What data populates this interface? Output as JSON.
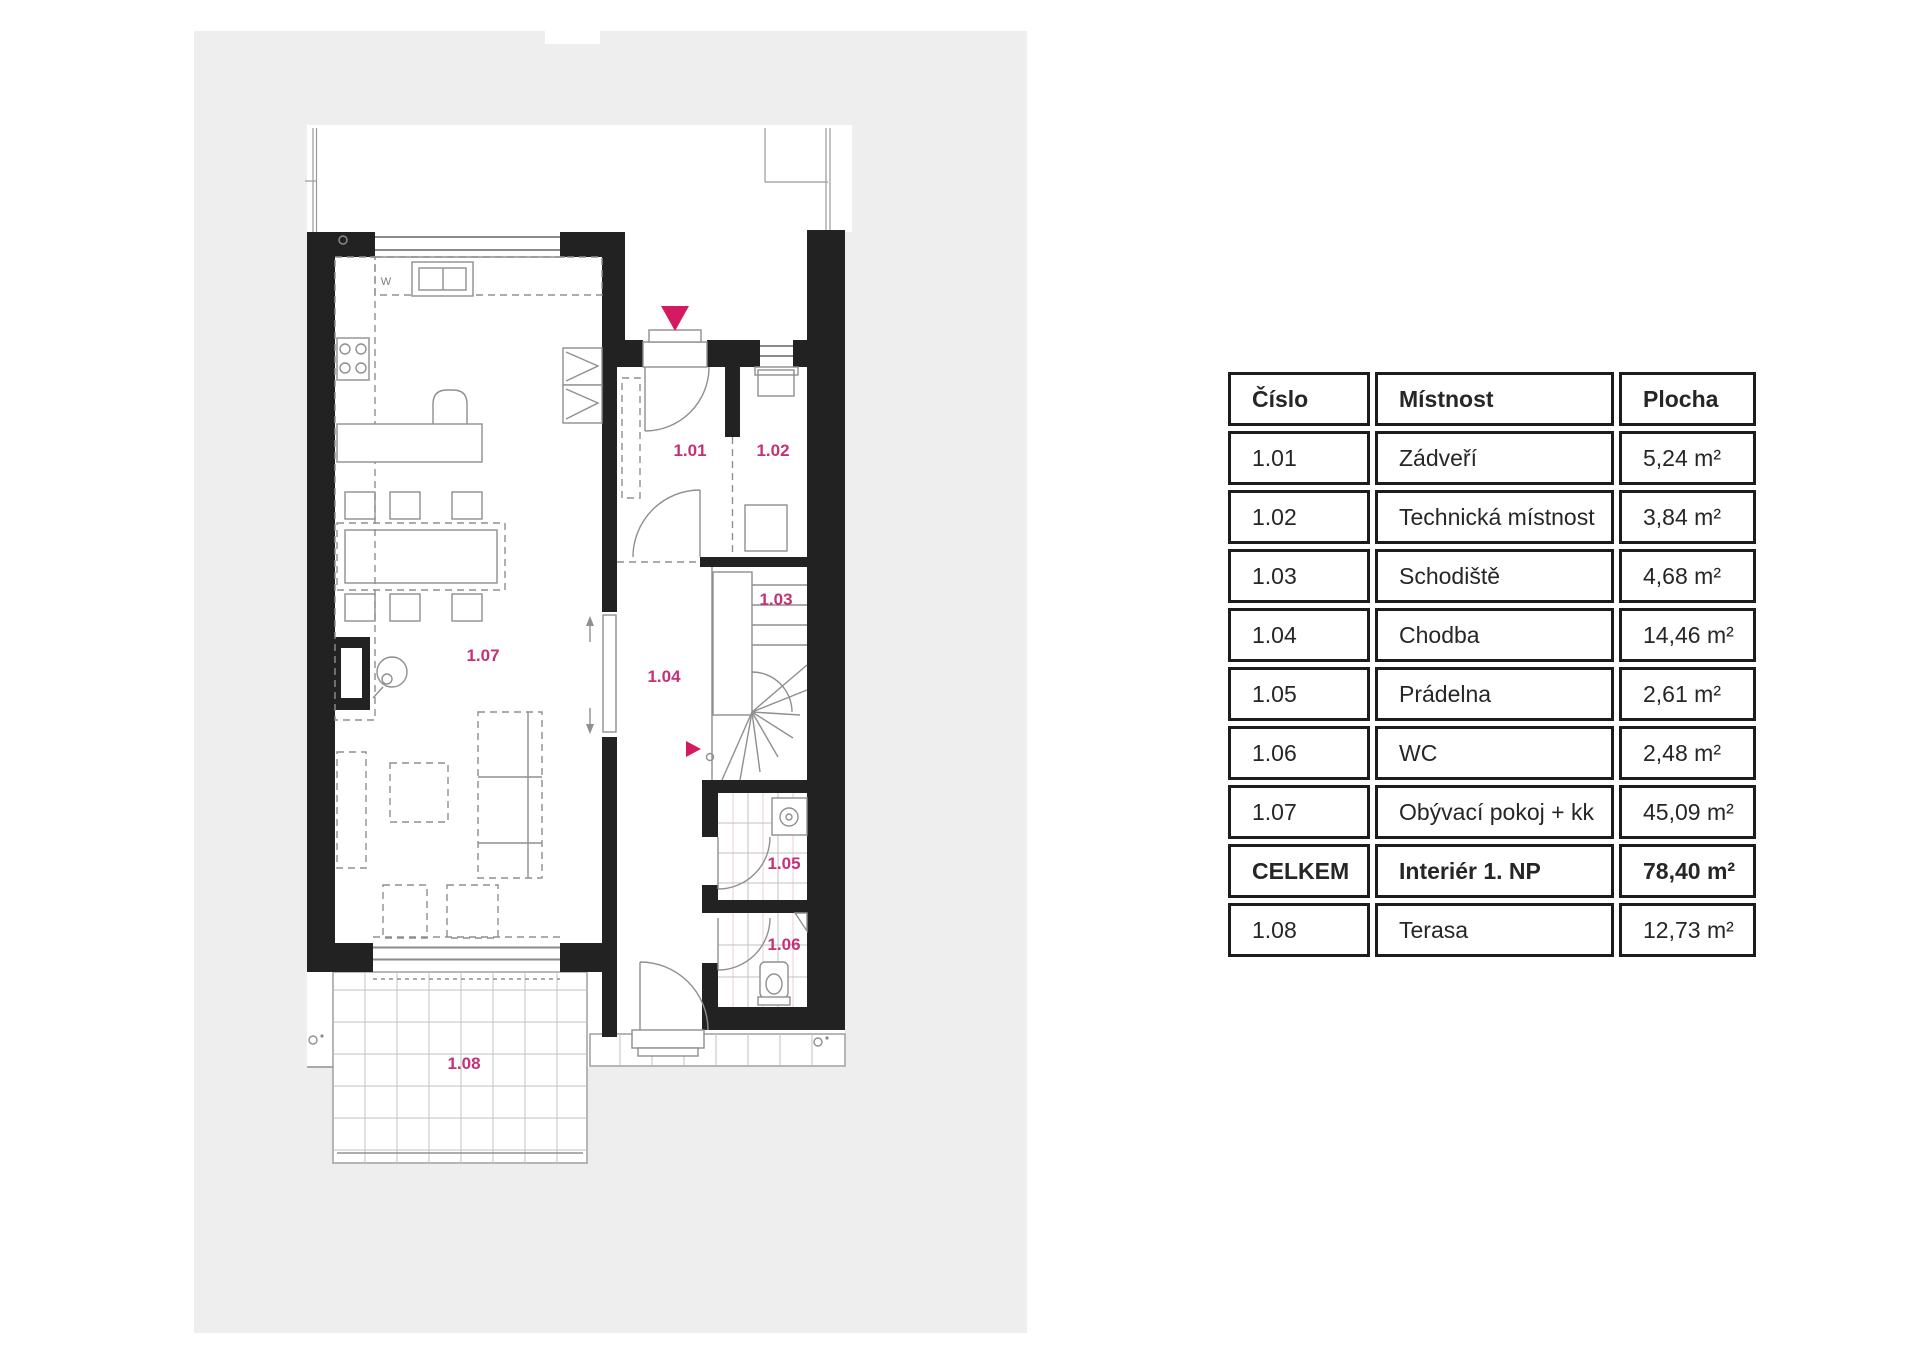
{
  "plan": {
    "panel_color": "#eeeeee",
    "wall_color": "#222222",
    "accent_marker_color": "#d41a60",
    "room_label_color": "#c53077",
    "kitchen_mark": "W",
    "labels": [
      {
        "id": "1.01",
        "text": "1.01"
      },
      {
        "id": "1.02",
        "text": "1.02"
      },
      {
        "id": "1.03",
        "text": "1.03"
      },
      {
        "id": "1.04",
        "text": "1.04"
      },
      {
        "id": "1.05",
        "text": "1.05"
      },
      {
        "id": "1.06",
        "text": "1.06"
      },
      {
        "id": "1.07",
        "text": "1.07"
      },
      {
        "id": "1.08",
        "text": "1.08"
      }
    ]
  },
  "table": {
    "border_color": "#1c1c1c",
    "columns": [
      "Číslo",
      "Místnost",
      "Plocha"
    ],
    "rows": [
      {
        "number": "1.01",
        "room": "Zádveří",
        "area": "5,24 m²",
        "bold": false
      },
      {
        "number": "1.02",
        "room": "Technická místnost",
        "area": "3,84 m²",
        "bold": false
      },
      {
        "number": "1.03",
        "room": "Schodiště",
        "area": "4,68 m²",
        "bold": false
      },
      {
        "number": "1.04",
        "room": "Chodba",
        "area": "14,46 m²",
        "bold": false
      },
      {
        "number": "1.05",
        "room": "Prádelna",
        "area": "2,61 m²",
        "bold": false
      },
      {
        "number": "1.06",
        "room": "WC",
        "area": "2,48 m²",
        "bold": false
      },
      {
        "number": "1.07",
        "room": "Obývací pokoj + kk",
        "area": "45,09 m²",
        "bold": false
      },
      {
        "number": "CELKEM",
        "room": "Interiér 1. NP",
        "area": "78,40 m²",
        "bold": true
      },
      {
        "number": "1.08",
        "room": "Terasa",
        "area": "12,73 m²",
        "bold": false
      }
    ]
  }
}
